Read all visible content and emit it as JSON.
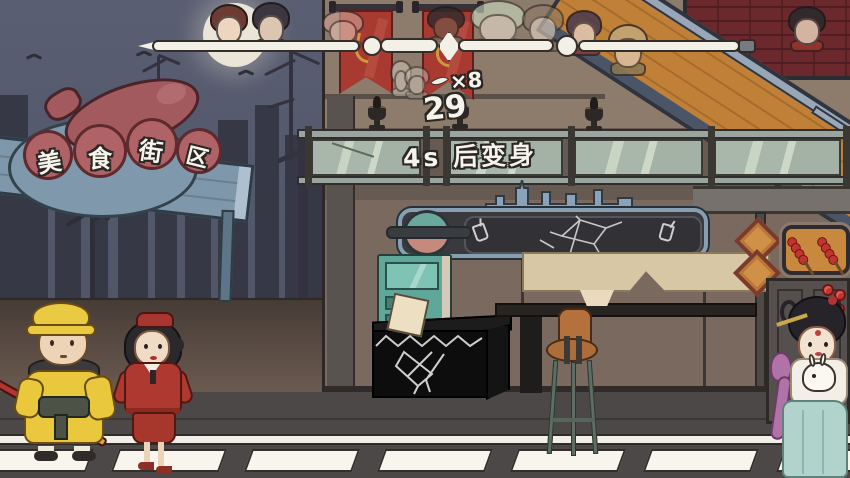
{
  "meta": {
    "scene_label": "美食街区"
  },
  "colors": {
    "sky_top": "#5a5e72",
    "sky_bottom": "#4c5060",
    "moon": "#eae5d6",
    "sign_red": "#a85d60",
    "board_blue": "#7e97ab",
    "arrow_teal": "#a9cfc2",
    "banner_red": "#a83a31",
    "staff_white": "#f3f0e7",
    "glass_green": "#a9b7aa",
    "wall_tan": "#8d7b6c",
    "brick_red": "#6b282d",
    "ramp_wood": "#c08038",
    "counter_black": "#0d0d0d",
    "vending_teal": "#5fa79a",
    "stool_brown": "#b06f3a",
    "road_grey": "#4b4847",
    "stripe_white": "#f7f5ee",
    "tanghulu_red": "#c23430"
  },
  "sign": {
    "title_chars": [
      "美",
      "食",
      "街",
      "区"
    ],
    "enter_label": "由此进入"
  },
  "hud": {
    "counter": "29",
    "transform_label": "4s 后变身",
    "multiplier": "×8"
  },
  "progress": {
    "avatars": [
      {
        "name": "avatar-stewardess",
        "x": 210,
        "y": 4,
        "w": 38,
        "h": 48,
        "hair": "#6e3b34",
        "face": "#ecd6c0",
        "accent": "#a5372e",
        "opacity": 1
      },
      {
        "name": "avatar-attendant",
        "x": 252,
        "y": 2,
        "w": 38,
        "h": 50,
        "hair": "#3c3640",
        "face": "#dcc6b2",
        "accent": "#55505c",
        "opacity": 1
      },
      {
        "name": "avatar-pig",
        "x": 322,
        "y": 10,
        "w": 42,
        "h": 40,
        "hair": "#cf9d93",
        "face": "#e3bdb2",
        "accent": "#b98d84",
        "opacity": 0.65
      },
      {
        "name": "avatar-darkface",
        "x": 427,
        "y": 6,
        "w": 38,
        "h": 40,
        "hair": "#2e2a2e",
        "face": "#7c5247",
        "accent": "#6e6862",
        "opacity": 0.8
      },
      {
        "name": "avatar-greenhair",
        "x": 470,
        "y": 0,
        "w": 56,
        "h": 52,
        "hair": "#ccdec0",
        "face": "#ece2d2",
        "accent": "#b8c8ae",
        "opacity": 0.6
      },
      {
        "name": "avatar-girl",
        "x": 522,
        "y": 4,
        "w": 42,
        "h": 48,
        "hair": "#8e7a66",
        "face": "#e8d8c6",
        "accent": "#7a6a58",
        "opacity": 0.6
      },
      {
        "name": "avatar-purplehair",
        "x": 566,
        "y": 10,
        "w": 36,
        "h": 46,
        "hair": "#4a3a50",
        "face": "#e2c8b4",
        "accent": "#8c3a38",
        "opacity": 0.85
      },
      {
        "name": "avatar-soldier",
        "x": 608,
        "y": 24,
        "w": 40,
        "h": 52,
        "hair": "#c2a878",
        "face": "#dcc2a4",
        "accent": "#8a7a52",
        "opacity": 0.85
      },
      {
        "name": "avatar-redhood",
        "x": 788,
        "y": 6,
        "w": 38,
        "h": 46,
        "hair": "#2e2a2c",
        "face": "#e0c4ae",
        "accent": "#97352f",
        "opacity": 0.9
      },
      {
        "name": "avatar-ghost-small",
        "x": 390,
        "y": 60,
        "w": 22,
        "h": 38,
        "hair": "#cfc6b8",
        "face": "#d8d0c2",
        "accent": "#bdb4a6",
        "opacity": 0.55
      },
      {
        "name": "avatar-ghost-small-2",
        "x": 404,
        "y": 66,
        "w": 26,
        "h": 34,
        "hair": "#c6bcae",
        "face": "#d5ccbe",
        "accent": "#b5ab9c",
        "opacity": 0.5
      }
    ]
  },
  "background": {
    "buildings": [
      {
        "x": 0,
        "w": 28,
        "y": 95
      },
      {
        "x": 28,
        "w": 20,
        "y": 140
      },
      {
        "x": 55,
        "w": 26,
        "y": 170
      },
      {
        "x": 90,
        "w": 18,
        "y": 150
      },
      {
        "x": 118,
        "w": 30,
        "y": 185
      },
      {
        "x": 155,
        "w": 22,
        "y": 160
      },
      {
        "x": 185,
        "w": 26,
        "y": 190
      },
      {
        "x": 218,
        "w": 30,
        "y": 120
      },
      {
        "x": 255,
        "w": 24,
        "y": 105
      },
      {
        "x": 285,
        "w": 45,
        "y": 135
      }
    ]
  },
  "road": {
    "stripes": {
      "count": 7,
      "first_x": -18,
      "step": 133,
      "width": 108,
      "top": 449,
      "height": 23
    }
  },
  "shop": {
    "window_skewers": [
      {
        "x": 796,
        "y": 234,
        "rot": -32
      },
      {
        "x": 826,
        "y": 234,
        "rot": -32
      }
    ],
    "tall_tanghulu_balls": [
      {
        "x": 822,
        "y": 284
      },
      {
        "x": 834,
        "y": 289
      },
      {
        "x": 820,
        "y": 297
      },
      {
        "x": 833,
        "y": 303
      },
      {
        "x": 822,
        "y": 311
      },
      {
        "x": 832,
        "y": 318
      },
      {
        "x": 825,
        "y": 326
      }
    ]
  }
}
